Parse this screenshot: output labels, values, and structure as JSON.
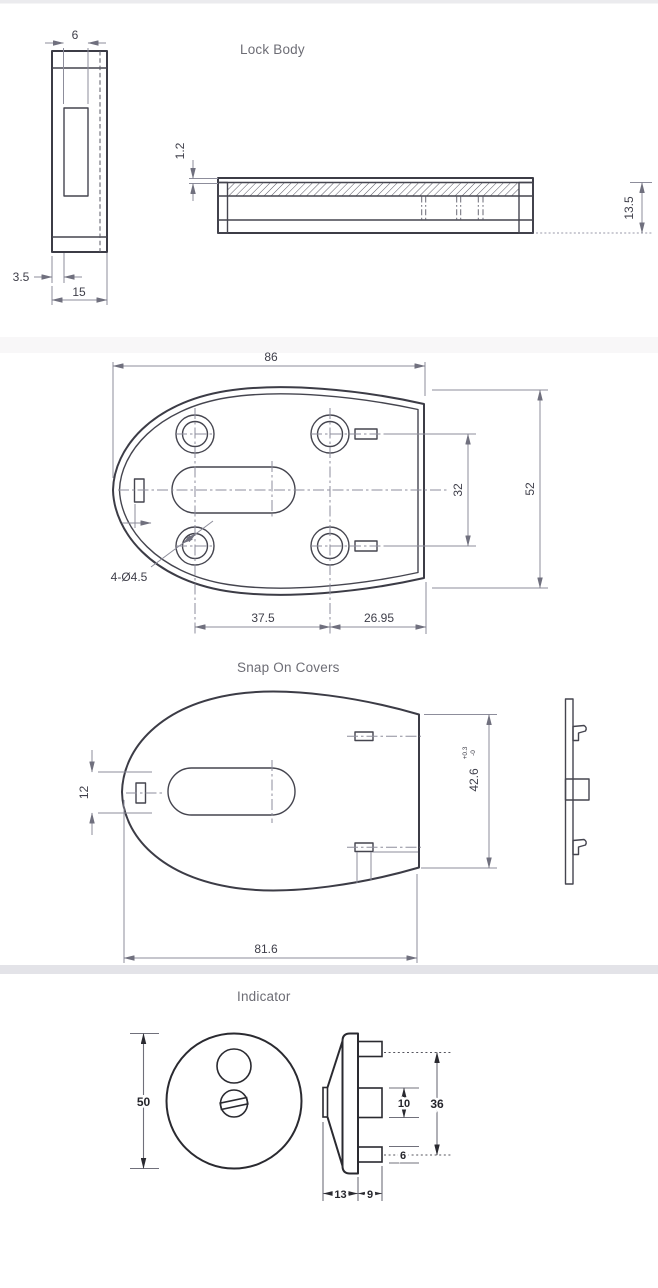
{
  "colors": {
    "background": "#ffffff",
    "outline": "#3c3c46",
    "dimension_lines": "#8d8d9b",
    "dimension_text": "#3e3e49",
    "section_titles": "#6d6d75",
    "indicator_outline": "#2a2a30",
    "scan_band": "#e3e3e8"
  },
  "lock_body": {
    "title": "Lock Body",
    "front_view": {
      "slot_width": "6",
      "edge_offset": "3.5",
      "body_width": "15"
    },
    "section_view": {
      "plate_thickness": "1.2",
      "body_height": "13.5"
    }
  },
  "base_plate": {
    "overall_width": "86",
    "hole_spacing_vertical": "32",
    "overall_height": "52",
    "holes_callout": "4-Ø4.5",
    "hole_spacing_horizontal": "37.5",
    "edge_distance": "26.95"
  },
  "snap_on_covers": {
    "title": "Snap On Covers",
    "slot_height": "12",
    "cover_height": "42.6",
    "cover_height_tol_upper": "+0.3",
    "cover_height_tol_lower": "-0",
    "overall_width": "81.6"
  },
  "indicator": {
    "title": "Indicator",
    "rose_diameter": "50",
    "tab_span": "36",
    "middle_tab_height": "10",
    "bottom_tab_height": "6",
    "cone_depth": "13",
    "tab_depth": "9"
  }
}
